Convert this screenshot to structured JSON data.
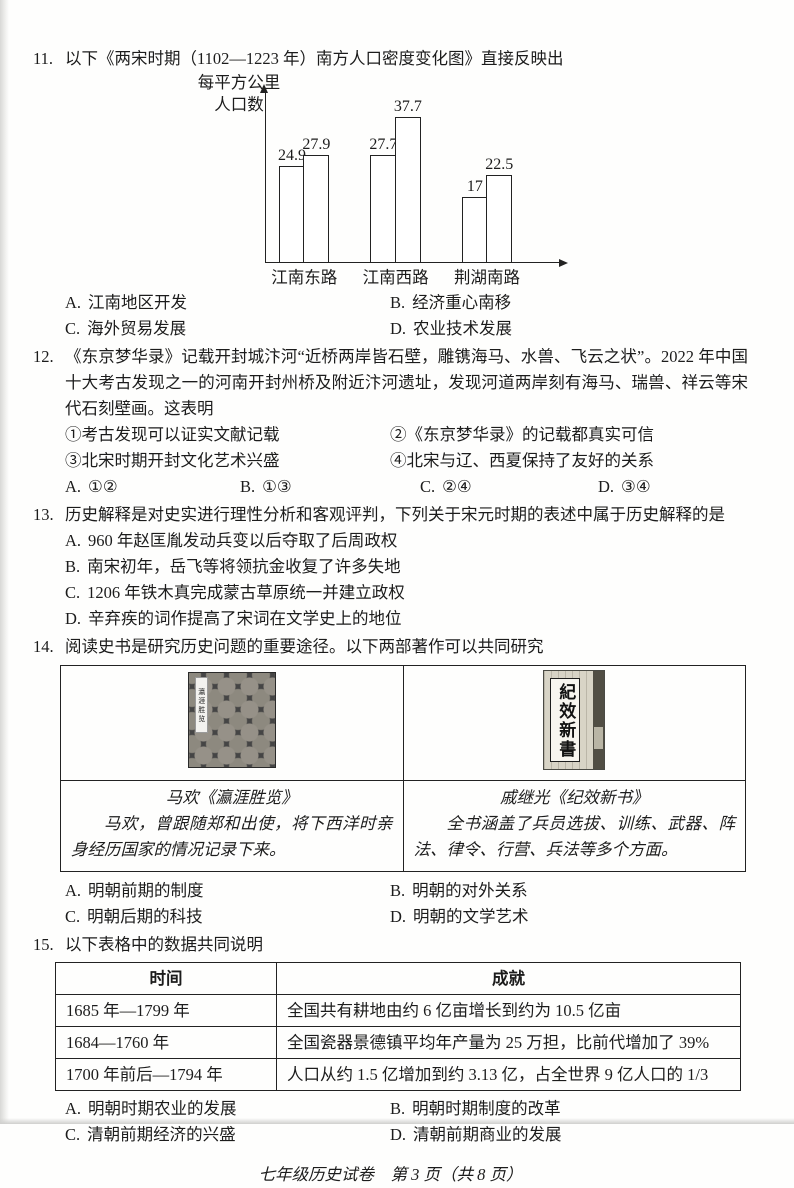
{
  "page": {
    "footer": "七年级历史试卷　第 3 页（共 8 页）"
  },
  "chart_data": {
    "type": "bar",
    "title": "两宋时期（1102—1223 年）南方人口密度变化图",
    "ylabel": "每平方公里人口数",
    "ylabel_lines": [
      "每平方公里",
      "人口数"
    ],
    "categories": [
      "江南东路",
      "江南西路",
      "荆湖南路"
    ],
    "series": [
      {
        "name": "",
        "values": [
          24.9,
          27.7,
          17
        ]
      },
      {
        "name": "",
        "values": [
          27.9,
          37.7,
          22.5
        ]
      }
    ],
    "value_labels": true,
    "ylim": [
      0,
      40
    ],
    "legend": "none",
    "grid": false
  },
  "q11": {
    "number": "11.",
    "stem": "以下《两宋时期（1102—1223 年）南方人口密度变化图》直接反映出",
    "options": [
      {
        "label": "A.",
        "text": "江南地区开发"
      },
      {
        "label": "B.",
        "text": "经济重心南移"
      },
      {
        "label": "C.",
        "text": "海外贸易发展"
      },
      {
        "label": "D.",
        "text": "农业技术发展"
      }
    ]
  },
  "q12": {
    "number": "12.",
    "stem": "《东京梦华录》记载开封城汴河“近桥两岸皆石壁，雕镌海马、水兽、飞云之状”。2022 年中国十大考古发现之一的河南开封州桥及附近汴河遗址，发现河道两岸刻有海马、瑞兽、祥云等宋代石刻壁画。这表明",
    "items": [
      "①考古发现可以证实文献记载",
      "②《东京梦华录》的记载都真实可信",
      "③北宋时期开封文化艺术兴盛",
      "④北宋与辽、西夏保持了友好的关系"
    ],
    "options": [
      {
        "label": "A.",
        "text": "①②"
      },
      {
        "label": "B.",
        "text": "①③"
      },
      {
        "label": "C.",
        "text": "②④"
      },
      {
        "label": "D.",
        "text": "③④"
      }
    ]
  },
  "q13": {
    "number": "13.",
    "stem": "历史解释是对史实进行理性分析和客观评判，下列关于宋元时期的表述中属于历史解释的是",
    "options": [
      {
        "label": "A.",
        "text": "960 年赵匡胤发动兵变以后夺取了后周政权"
      },
      {
        "label": "B.",
        "text": "南宋初年，岳飞等将领抗金收复了许多失地"
      },
      {
        "label": "C.",
        "text": "1206 年铁木真完成蒙古草原统一并建立政权"
      },
      {
        "label": "D.",
        "text": "辛弃疾的词作提高了宋词在文学史上的地位"
      }
    ]
  },
  "q14": {
    "number": "14.",
    "stem": "阅读史书是研究历史问题的重要途径。以下两部著作可以共同研究",
    "left": {
      "book_label": "瀛涯胜览",
      "title": "马欢《瀛涯胜览》",
      "desc": "马欢，曾跟随郑和出使，将下西洋时亲身经历国家的情况记录下来。"
    },
    "right": {
      "book_title_vertical": "紀效新書",
      "title": "戚继光《纪效新书》",
      "desc": "全书涵盖了兵员选拔、训练、武器、阵法、律令、行营、兵法等多个方面。"
    },
    "options": [
      {
        "label": "A.",
        "text": "明朝前期的制度"
      },
      {
        "label": "B.",
        "text": "明朝的对外关系"
      },
      {
        "label": "C.",
        "text": "明朝后期的科技"
      },
      {
        "label": "D.",
        "text": "明朝的文学艺术"
      }
    ]
  },
  "q15": {
    "number": "15.",
    "stem": "以下表格中的数据共同说明",
    "table": {
      "headers": [
        "时间",
        "成就"
      ],
      "rows": [
        [
          "1685 年—1799 年",
          "全国共有耕地由约 6 亿亩增长到约为 10.5 亿亩"
        ],
        [
          "1684—1760 年",
          "全国瓷器景德镇平均年产量为 25 万担，比前代增加了 39%"
        ],
        [
          "1700 年前后—1794 年",
          "人口从约 1.5 亿增加到约 3.13 亿，占全世界 9 亿人口的 1/3"
        ]
      ]
    },
    "options": [
      {
        "label": "A.",
        "text": "明朝时期农业的发展"
      },
      {
        "label": "B.",
        "text": "明朝时期制度的改革"
      },
      {
        "label": "C.",
        "text": "清朝前期经济的兴盛"
      },
      {
        "label": "D.",
        "text": "清朝前期商业的发展"
      }
    ]
  }
}
